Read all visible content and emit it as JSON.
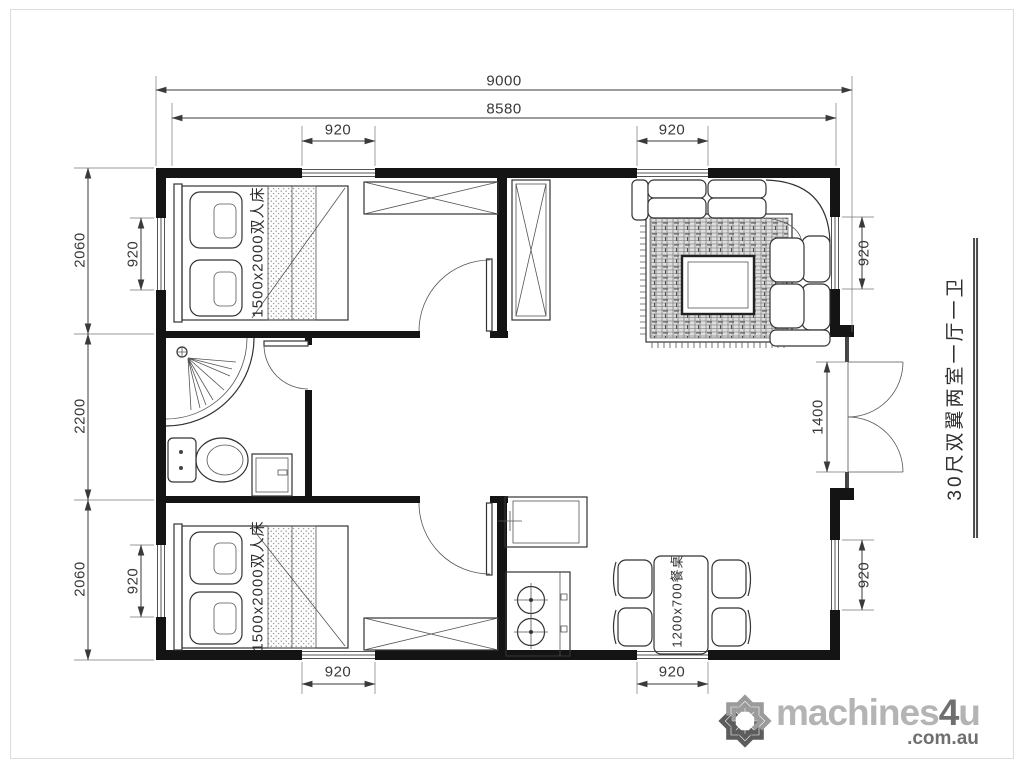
{
  "plan": {
    "dimensions": {
      "overall_width": "9000",
      "usable_width": "8580",
      "room_depth_top": "2060",
      "bath_zone_depth": "2200",
      "room_depth_bottom": "2060",
      "entry_door_width": "1400",
      "window_top_bedroom": "920",
      "window_top_living": "920",
      "window_left_bedroom_top": "920",
      "window_left_bedroom_bottom": "920",
      "window_right_living": "920",
      "window_right_dining": "920",
      "window_bottom_bedroom": "920",
      "window_bottom_dining": "920"
    },
    "furniture_labels": {
      "bed_top": "1500x2000双人床",
      "bed_bottom": "1500x2000双人床",
      "dining_table": "1200x700餐桌"
    },
    "side_title": "30尺双翼两室一厅一卫"
  },
  "watermark": {
    "brand_machines": "machines",
    "brand_4": "4",
    "brand_u": "u",
    "brand_domain": ".com.au"
  },
  "colors": {
    "walls": "#141414",
    "lines": "#3a3a3a",
    "logo_light": "#b4b4b4",
    "logo_dark": "#6f6f6f"
  }
}
